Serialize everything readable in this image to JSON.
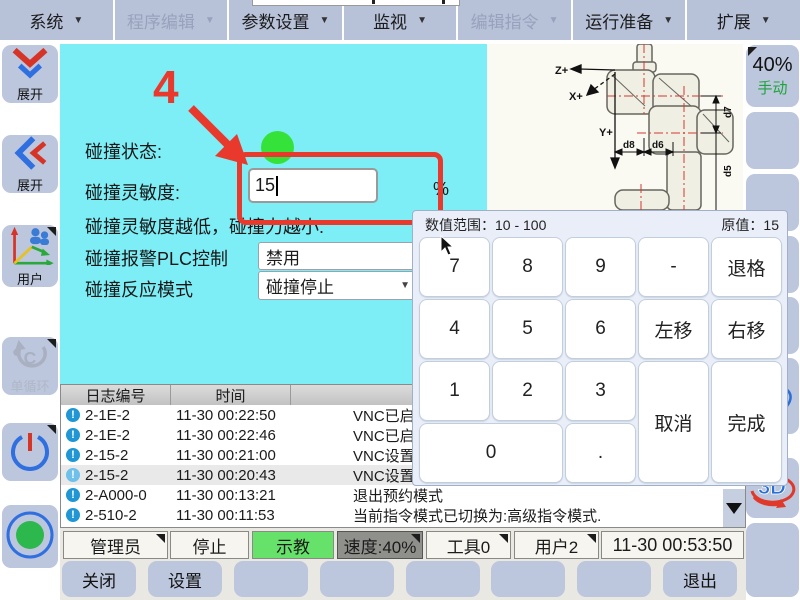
{
  "colors": {
    "panel_cyan": "#7deef6",
    "button_blue": "#bcc6dc",
    "status_green": "#35e23a",
    "teach_green": "#66e26a",
    "highlight_red": "#e8392c"
  },
  "menu": {
    "items": [
      {
        "label": "系统"
      },
      {
        "label": "程序编辑"
      },
      {
        "label": "参数设置"
      },
      {
        "label": "监视"
      },
      {
        "label": "编辑指令"
      },
      {
        "label": "运行准备"
      },
      {
        "label": "扩展"
      }
    ]
  },
  "sidebar": {
    "buttons": [
      {
        "label": "展开"
      },
      {
        "label": "展开"
      },
      {
        "label": "用户"
      },
      {
        "label": "单循环"
      },
      {
        "label": ""
      },
      {
        "label": ""
      }
    ]
  },
  "main": {
    "annotation": "4",
    "status_label": "碰撞状态:",
    "sensitivity_label": "碰撞灵敏度:",
    "sensitivity_value": "15",
    "unit": "%",
    "hint": "碰撞灵敏度越低，碰撞力越小.",
    "plc_label": "碰撞报警PLC控制",
    "plc_value": "禁用",
    "mode_label": "碰撞反应模式",
    "mode_value": "碰撞停止"
  },
  "robot": {
    "z": "Z+",
    "x": "X+",
    "y": "Y+",
    "d7": "d7",
    "d8": "d8",
    "d6": "d6",
    "d5": "d5"
  },
  "right_column": {
    "speed": "40%",
    "mode": "手动",
    "view3d": "3D"
  },
  "keypad": {
    "range": "数值范围：10 - 100",
    "original": "原值：15",
    "keys": [
      "7",
      "8",
      "9",
      "-",
      "退格",
      "4",
      "5",
      "6",
      "左移",
      "右移",
      "1",
      "2",
      "3",
      "取消",
      "完成",
      "0",
      "."
    ]
  },
  "log": {
    "headers": [
      "日志编号",
      "时间"
    ],
    "rows": [
      {
        "code": "2-1E-2",
        "time": "11-30 00:22:50",
        "msg": "VNC已启动!"
      },
      {
        "code": "2-1E-2",
        "time": "11-30 00:22:46",
        "msg": "VNC已启动!"
      },
      {
        "code": "2-15-2",
        "time": "11-30 00:21:00",
        "msg": "VNC设置成功！"
      },
      {
        "code": "2-15-2",
        "time": "11-30 00:20:43",
        "msg": "VNC设置成功！"
      },
      {
        "code": "2-A000-0",
        "time": "11-30 00:13:21",
        "msg": "退出预约模式"
      },
      {
        "code": "2-510-2",
        "time": "11-30 00:11:53",
        "msg": "当前指令模式已切换为:高级指令模式."
      }
    ]
  },
  "statusbar": {
    "role": "管理员",
    "run_state": "停止",
    "teach_mode": "示教",
    "speed": "速度:40%",
    "tool": "工具0",
    "user": "用户2",
    "time": "11-30 00:53:50"
  },
  "bottombar": {
    "buttons": [
      "关闭",
      "设置",
      "",
      "",
      "",
      "",
      "",
      "退出"
    ]
  }
}
